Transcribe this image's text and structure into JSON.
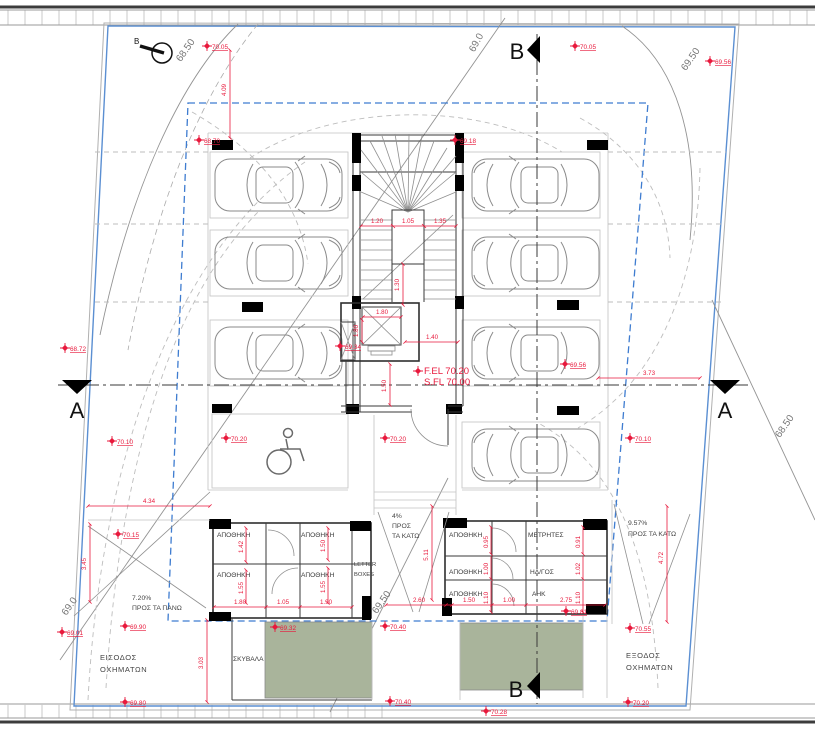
{
  "north": {
    "label": "B"
  },
  "sections": {
    "a_left": "A",
    "a_right": "A",
    "b_top": "B",
    "b_bottom": "B"
  },
  "contours": {
    "top_left": "68.50",
    "top_center": "69.0",
    "top_right": "69.50",
    "right": "68.50",
    "bottom_left": "69.0",
    "bottom_center": "69.50"
  },
  "levels": {
    "fel": "F.EL 70.20",
    "sfl": "S.FL 70.00"
  },
  "spots": {
    "tl": "70.05",
    "tr": "70.05",
    "tr_corner": "69.56",
    "top_post": "68.70",
    "top_post_right": "69.18",
    "left_edge": "68.72",
    "left_row": "70.10",
    "right_row": "70.10",
    "right_mid": "69.56",
    "core": "69.34",
    "lobby": "70.20",
    "disabled": "70.20",
    "ramp_left_top": "70.15",
    "ramp_left_mid": "69.90",
    "ramp_left_edge": "69.01",
    "ramp_left_bottom": "69.80",
    "planter_left": "69.32",
    "walk_top": "70.40",
    "walk_bottom": "70.40",
    "bottom_mid": "70.28",
    "block_right": "69.81",
    "ramp_right_top": "70.55",
    "ramp_right_bottom": "70.20"
  },
  "dims": {
    "top": "4.09",
    "stair_l": "1.20",
    "stair_m": "1.05",
    "stair_r": "1.35",
    "stair_b": "1.30",
    "lift_w": "1.80",
    "lift_h": "1.80",
    "lobby_w": "1.40",
    "lobby_h": "1.50",
    "right_gap": "3.73",
    "ramp_left_w": "4.34",
    "ramp_left_h": "3.45",
    "garbage_h": "3.03",
    "lb_v1": "1.42",
    "lb_v2": "1.55",
    "lb_v3": "1.50",
    "lb_v4": "1.55",
    "lb_w1": "1.80",
    "lb_w2": "1.05",
    "lb_w3": "1.90",
    "ramp_c_h": "5.11",
    "ramp_c_w": "2.60",
    "rb_v1": "0.95",
    "rb_v2": "1.00",
    "rb_v3": "1.10",
    "rb_v4": "0.91",
    "rb_v5": "1.02",
    "rb_v6": "1.10",
    "rb_w1": "1.50",
    "rb_w2": "1.00",
    "rb_w3": "2.75",
    "ramp_right_h": "4.72"
  },
  "rooms": {
    "storage": "ΑΠΟΘΗΚΗ",
    "meters": "ΜΕΤΡΗΤΕΣ",
    "electrical": "ΗΛ/ΓΟΣ",
    "eac": "ΑΗΚ",
    "letter1": "LETTER",
    "letter2": "BOXES",
    "garbage": "ΣΚΥΒΑΛΑ"
  },
  "ramps": {
    "left_pct": "7.20%",
    "left_dir": "ΠΡΟΣ ΤΑ ΠΑΝΩ",
    "center_pct": "4%",
    "center_dir1": "ΠΡΟΣ",
    "center_dir2": "ΤΑ ΚΑΤΩ",
    "right_pct": "9.57%",
    "right_dir": "ΠΡΟΣ ΤΑ ΚΑΤΩ"
  },
  "labels": {
    "entrance1": "ΕΙΣΟΔΟΣ",
    "entrance2": "ΟΧΗΜΑΤΩΝ",
    "exit1": "ΕΞΟΔΟΣ",
    "exit2": "ΟΧΗΜΑΤΩΝ"
  },
  "colors": {
    "red": "#e8193c",
    "blue": "#5b8fd2",
    "envelope": "#3e7cd0",
    "green": "#a9b49b"
  }
}
